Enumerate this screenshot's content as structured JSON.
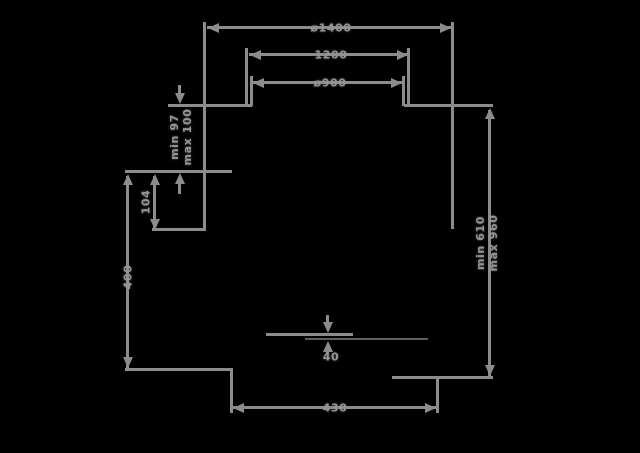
{
  "drawing": {
    "bg": "#000000",
    "line_color": "#8c8c8c",
    "dark_line_color": "#5e5e5e",
    "text_color": "#949494",
    "lines": [
      {
        "d": "h",
        "x": 207,
        "y": 26,
        "l": 246
      },
      {
        "d": "h",
        "x": 249,
        "y": 53,
        "l": 160
      },
      {
        "d": "h",
        "x": 252,
        "y": 81,
        "l": 152
      },
      {
        "d": "h",
        "x": 168,
        "y": 104,
        "l": 84
      },
      {
        "d": "h",
        "x": 404,
        "y": 104,
        "l": 89
      },
      {
        "d": "h",
        "x": 125,
        "y": 170,
        "l": 107
      },
      {
        "d": "h",
        "x": 152,
        "y": 228,
        "l": 54
      },
      {
        "d": "h",
        "x": 125,
        "y": 368,
        "l": 108
      },
      {
        "d": "h",
        "x": 392,
        "y": 376,
        "l": 101
      },
      {
        "d": "h",
        "x": 232,
        "y": 406,
        "l": 206
      },
      {
        "d": "h",
        "x": 266,
        "y": 333,
        "l": 87
      },
      {
        "d": "h",
        "x": 305,
        "y": 338,
        "l": 123,
        "c": "#5e5e5e",
        "t": 2
      },
      {
        "d": "v",
        "x": 203,
        "y": 22,
        "l": 209
      },
      {
        "d": "v",
        "x": 451,
        "y": 22,
        "l": 207
      },
      {
        "d": "v",
        "x": 245,
        "y": 48,
        "l": 58
      },
      {
        "d": "v",
        "x": 250,
        "y": 76,
        "l": 30
      },
      {
        "d": "v",
        "x": 407,
        "y": 48,
        "l": 58
      },
      {
        "d": "v",
        "x": 402,
        "y": 76,
        "l": 30
      },
      {
        "d": "v",
        "x": 178,
        "y": 85,
        "l": 14
      },
      {
        "d": "v",
        "x": 178,
        "y": 182,
        "l": 12
      },
      {
        "d": "v",
        "x": 153,
        "y": 176,
        "l": 53
      },
      {
        "d": "v",
        "x": 126,
        "y": 176,
        "l": 193
      },
      {
        "d": "v",
        "x": 488,
        "y": 110,
        "l": 266
      },
      {
        "d": "v",
        "x": 230,
        "y": 370,
        "l": 43
      },
      {
        "d": "v",
        "x": 436,
        "y": 378,
        "l": 35
      },
      {
        "d": "v",
        "x": 326,
        "y": 315,
        "l": 12
      },
      {
        "d": "v",
        "x": 326,
        "y": 347,
        "l": 7
      }
    ],
    "arrows": [
      {
        "dir": "left",
        "x": 208,
        "y": 28
      },
      {
        "dir": "right",
        "x": 451,
        "y": 28
      },
      {
        "dir": "left",
        "x": 250,
        "y": 55
      },
      {
        "dir": "right",
        "x": 408,
        "y": 55
      },
      {
        "dir": "left",
        "x": 253,
        "y": 83
      },
      {
        "dir": "right",
        "x": 402,
        "y": 83
      },
      {
        "dir": "down",
        "x": 180,
        "y": 104
      },
      {
        "dir": "up",
        "x": 180,
        "y": 173
      },
      {
        "dir": "up",
        "x": 155,
        "y": 174
      },
      {
        "dir": "down",
        "x": 155,
        "y": 230
      },
      {
        "dir": "up",
        "x": 128,
        "y": 174
      },
      {
        "dir": "down",
        "x": 128,
        "y": 368
      },
      {
        "dir": "up",
        "x": 490,
        "y": 108
      },
      {
        "dir": "down",
        "x": 490,
        "y": 376
      },
      {
        "dir": "left",
        "x": 233,
        "y": 408
      },
      {
        "dir": "right",
        "x": 436,
        "y": 408
      },
      {
        "dir": "down",
        "x": 328,
        "y": 333
      },
      {
        "dir": "up",
        "x": 328,
        "y": 341
      }
    ]
  },
  "labels": {
    "outer_diameter": "ø1400",
    "mid_width": "1200",
    "inner_diameter": "ø900",
    "mount_min": "min 97",
    "mount_max": "max 100",
    "side_offset": "104",
    "left_height": "400",
    "height_min": "min 610",
    "height_max": "max 960",
    "base_width": "430",
    "gap": "40"
  }
}
